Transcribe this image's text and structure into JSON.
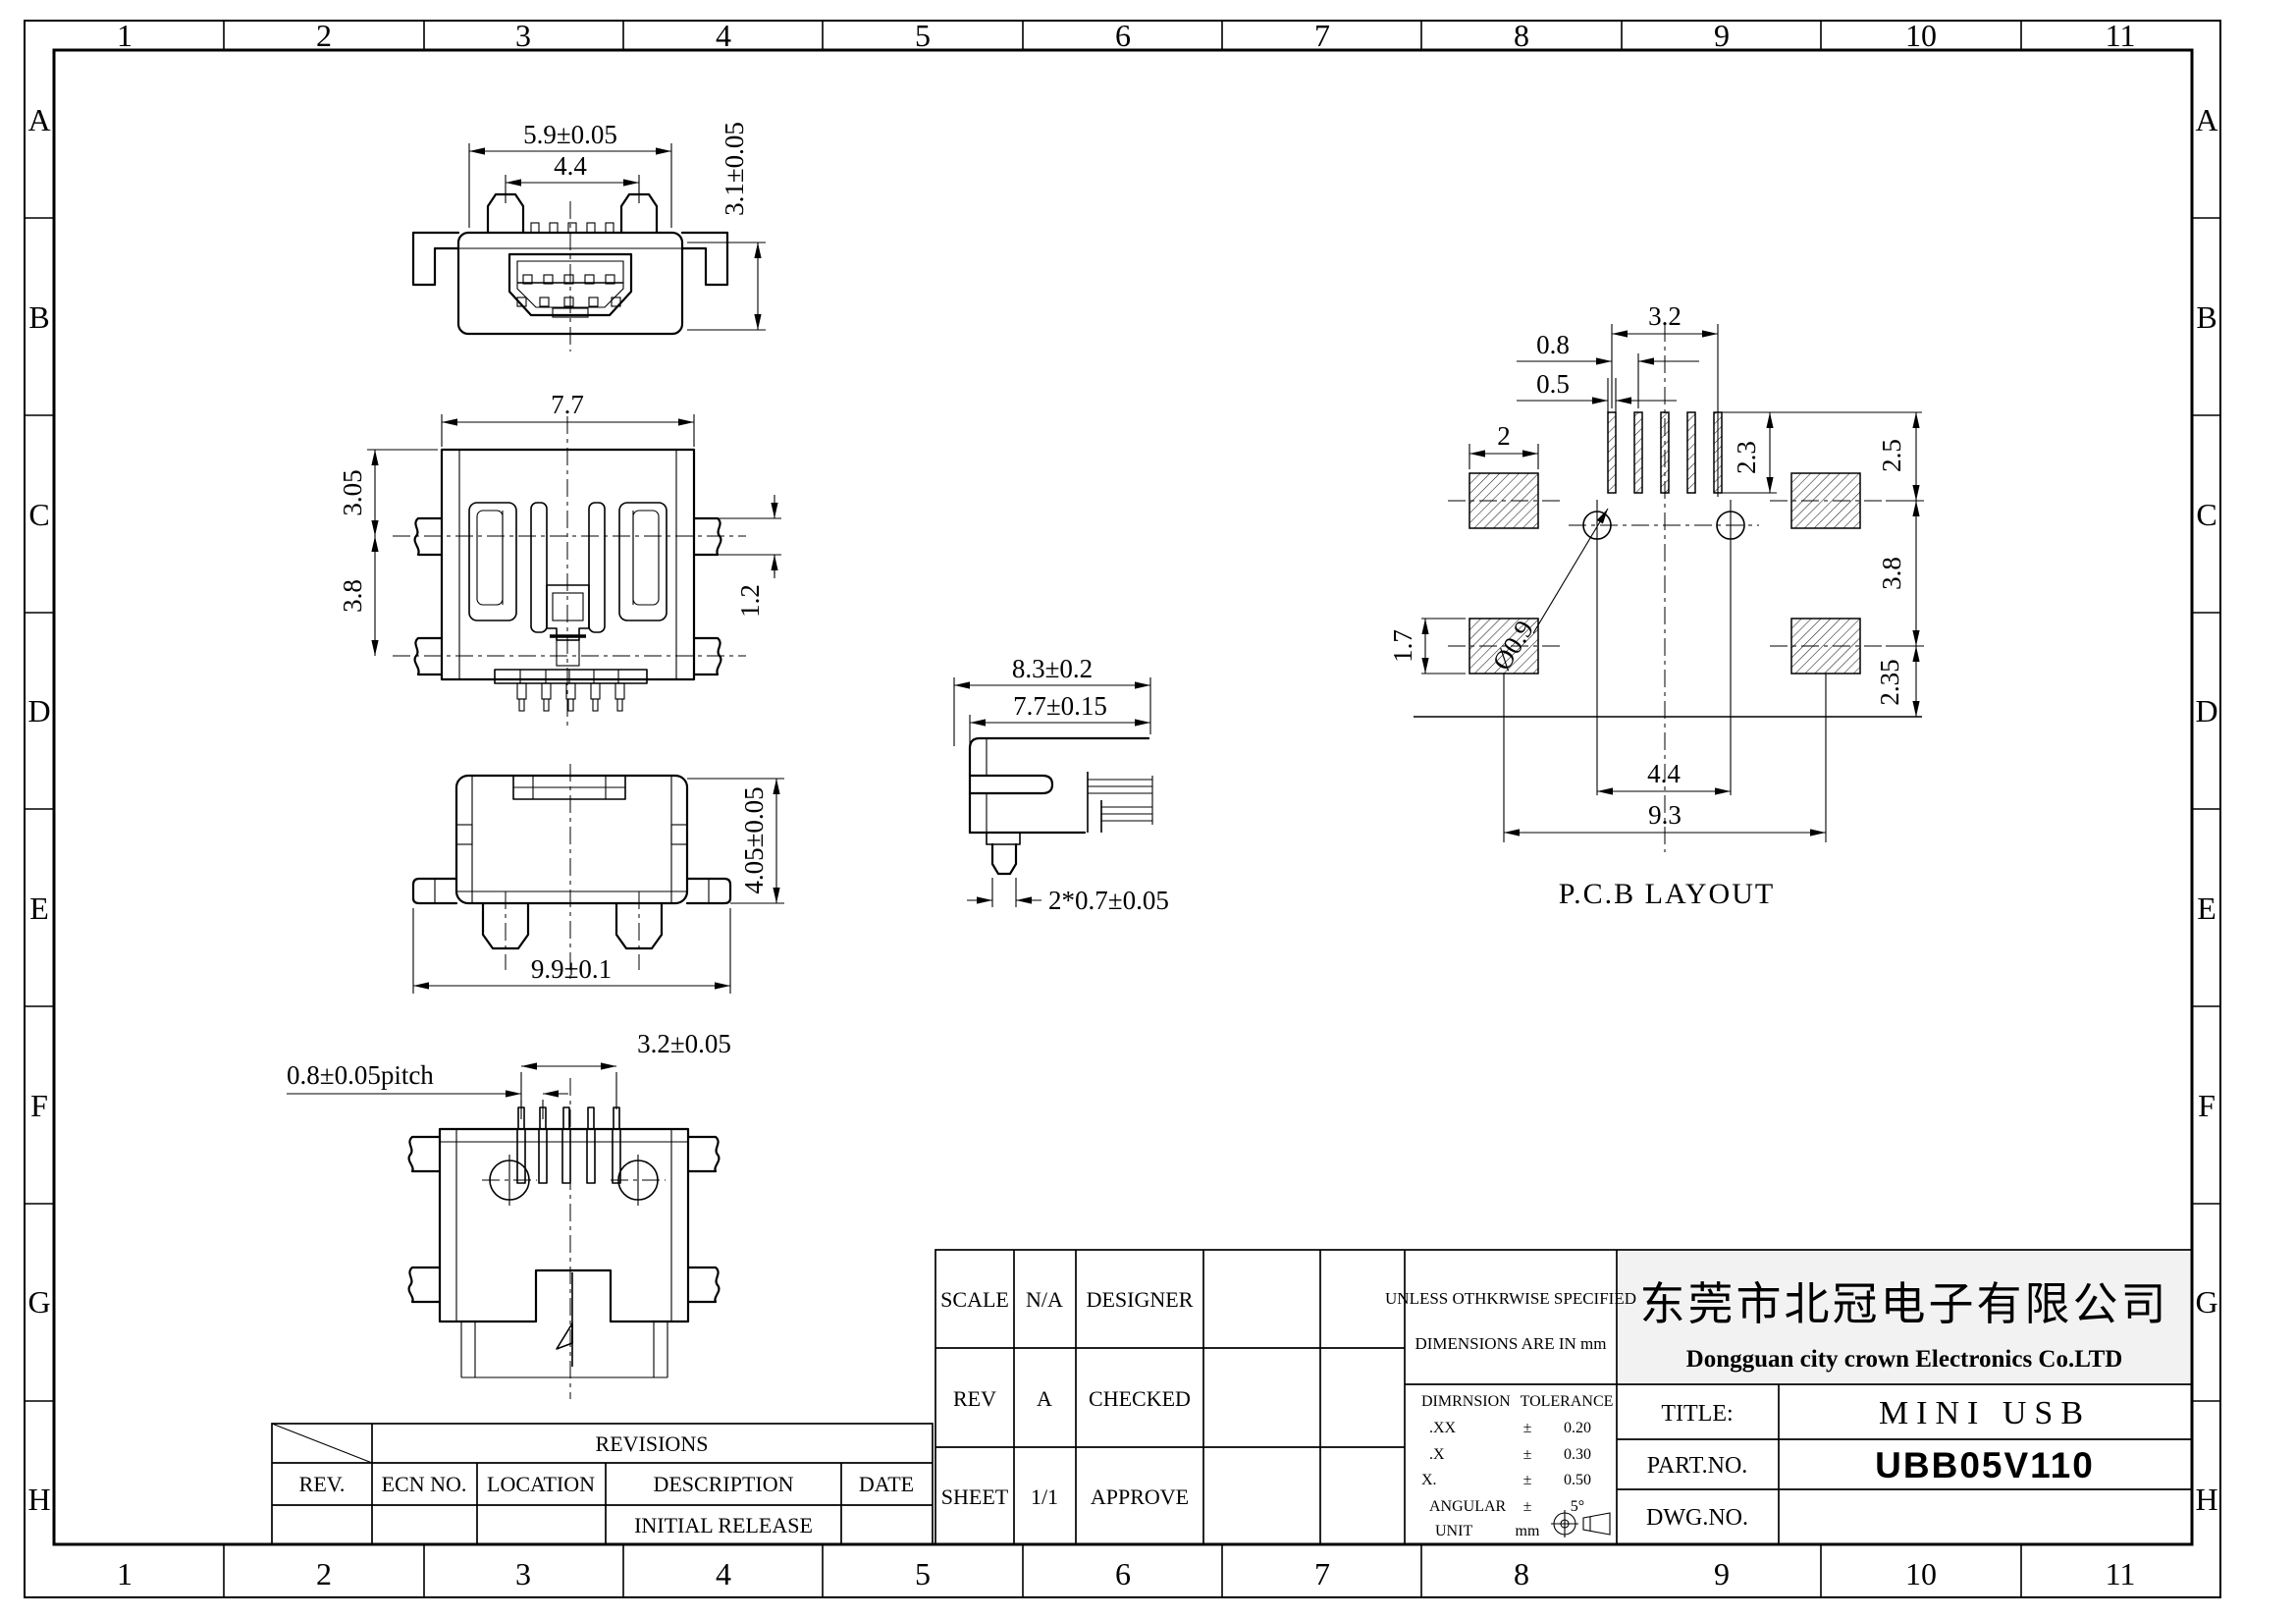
{
  "sheet": {
    "grid": {
      "cols": [
        "1",
        "2",
        "3",
        "4",
        "5",
        "6",
        "7",
        "8",
        "9",
        "10",
        "11"
      ],
      "rows": [
        "A",
        "B",
        "C",
        "D",
        "E",
        "F",
        "G",
        "H"
      ]
    },
    "views": {
      "front": {
        "dims": {
          "outer": "5.9±0.05",
          "inner": "4.4",
          "height": "3.1±0.05"
        }
      },
      "top": {
        "dims": {
          "width": "7.7",
          "upper": "3.05",
          "lower": "3.8",
          "leg": "1.2"
        }
      },
      "back": {
        "dims": {
          "height": "4.05±0.05",
          "width": "9.9±0.1"
        }
      },
      "bottom": {
        "dims": {
          "pitch": "0.8±0.05pitch",
          "span": "3.2±0.05"
        }
      },
      "side": {
        "dims": {
          "outer": "8.3±0.2",
          "inner": "7.7±0.15",
          "posts": "2*0.7±0.05"
        }
      },
      "pcb": {
        "label": "P.C.B LAYOUT",
        "dims": {
          "slot_span": "3.2",
          "pitch": "0.8",
          "slot_w": "0.5",
          "pad_w": "2",
          "slot_len": "2.3",
          "upper": "2.5",
          "mid": "3.8",
          "lower": "2.35",
          "pad_h": "1.7",
          "hole": "Ø0.9",
          "hole_span": "4.4",
          "pad_span": "9.3"
        }
      }
    },
    "revisions": {
      "title": "REVISIONS",
      "headers": [
        "REV.",
        "ECN NO.",
        "LOCATION",
        "DESCRIPTION",
        "DATE"
      ],
      "rows": [
        [
          "",
          "",
          "",
          "INITIAL RELEASE",
          ""
        ]
      ]
    },
    "title_block": {
      "scale_label": "SCALE",
      "scale_value": "N/A",
      "designer_label": "DESIGNER",
      "rev_label": "REV",
      "rev_value": "A",
      "checked_label": "CHECKED",
      "sheet_label": "SHEET",
      "sheet_value": "1/1",
      "approve_label": "APPROVE",
      "spec_line1": "UNLESS OTHKRWISE SPECIFIED",
      "spec_line2": "DIMENSIONS ARE IN mm",
      "tolerance": {
        "dim_header": "DIMRNSION",
        "tol_header": "TOLERANCE",
        "rows": [
          [
            ".XX",
            "±",
            "0.20"
          ],
          [
            ".X",
            "±",
            "0.30"
          ],
          [
            "X.",
            "±",
            "0.50"
          ],
          [
            "ANGULAR",
            "±",
            "5°"
          ],
          [
            "UNIT",
            "mm",
            ""
          ]
        ]
      },
      "company_cn": "东莞市北冠电子有限公司",
      "company_en": "Dongguan city crown Electronics Co.LTD",
      "title_label": "TITLE:",
      "title_value": "MINI USB",
      "part_label": "PART.NO.",
      "part_value": "UBB05V110",
      "dwg_label": "DWG.NO.",
      "dwg_value": ""
    }
  }
}
